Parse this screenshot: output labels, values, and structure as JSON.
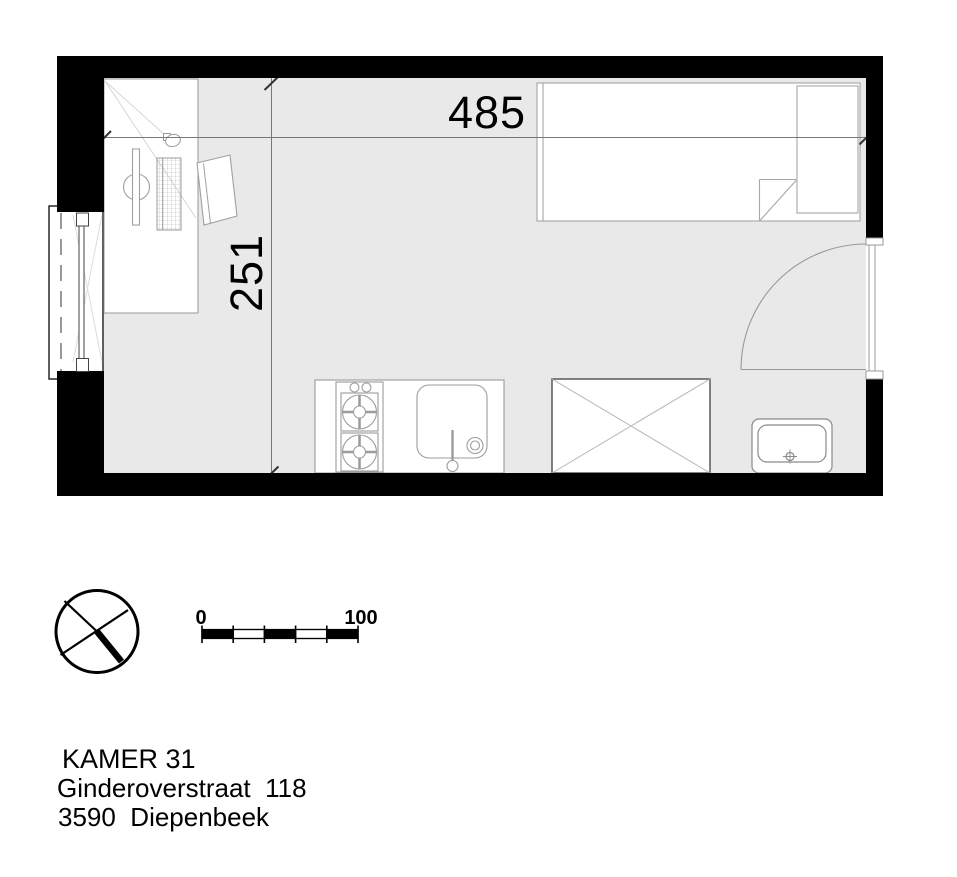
{
  "title_block": {
    "room": "KAMER 31",
    "street": "Ginderoverstraat  118",
    "city": "3590  Diepenbeek"
  },
  "dimensions": {
    "width_cm": "485",
    "depth_cm": "251"
  },
  "scale_bar": {
    "start": "0",
    "end": "100"
  },
  "plan": {
    "furniture": [
      "desk",
      "office-chair",
      "monitor",
      "keyboard",
      "mouse",
      "single-bed",
      "pillow",
      "blanket-fold",
      "kitchen-counter",
      "stove-two-burners",
      "kitchen-sink",
      "faucet",
      "dining-table",
      "washbasin"
    ],
    "fixtures": [
      "entrance-door",
      "door-swing-arc",
      "casement-window",
      "north-arrow",
      "scale-bar"
    ]
  },
  "colors": {
    "wall": "#000000",
    "floor": "#e9e9e9",
    "outline_light": "#a0a0a0",
    "outline_dark": "#4d4d4d",
    "dimension_line": "#777777",
    "text": "#000000"
  }
}
